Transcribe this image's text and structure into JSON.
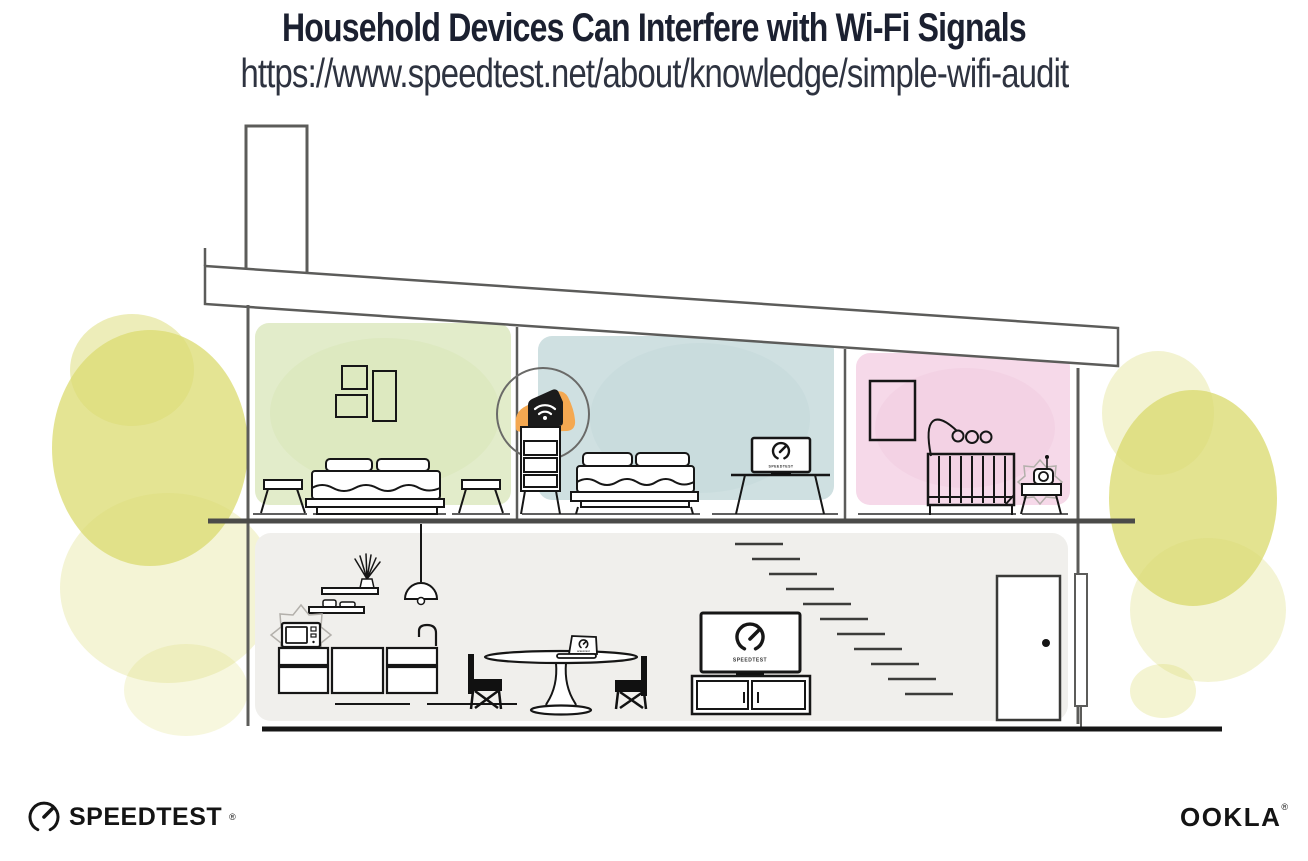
{
  "header": {
    "title": "Household Devices Can Interfere with Wi-Fi Signals",
    "url": "https://www.speedtest.net/about/knowledge/simple-wifi-audit"
  },
  "branding": {
    "speedtest_wordmark": "SPEEDTEST",
    "speedtest_trademark": "®",
    "ookla_wordmark": "OOKLA",
    "ookla_trademark": "®"
  },
  "screens": {
    "bedroom_tv_label": "SPEEDTEST",
    "living_tv_label": "SPEEDTEST",
    "laptop_label": "SPEEDTEST"
  },
  "scene": {
    "floors": [
      "upper floor",
      "main floor"
    ],
    "rooms": [
      "bedroom-left",
      "bedroom-middle",
      "nursery",
      "kitchen-living-area"
    ],
    "depicted_devices": [
      "wifi-router",
      "bedroom-tv",
      "baby-monitor",
      "microwave",
      "laptop",
      "living-room-tv"
    ]
  },
  "icons": {
    "router": "wifi-icon",
    "gauge": "speedtest-gauge-icon",
    "interference": "interference-burst-icon"
  },
  "colors": {
    "title_text": "#1b2030",
    "url_text": "#2e3340",
    "accent_orange": "#f4a851",
    "room_green": "#e2ecca",
    "room_blue": "#cfe0e1",
    "room_pink": "#f6d9e9",
    "floor_gray": "#f0efec",
    "foliage_yellow": "#dcdc74",
    "line_dark": "#1a1a1a",
    "wall_gray": "#5c5c5a"
  }
}
